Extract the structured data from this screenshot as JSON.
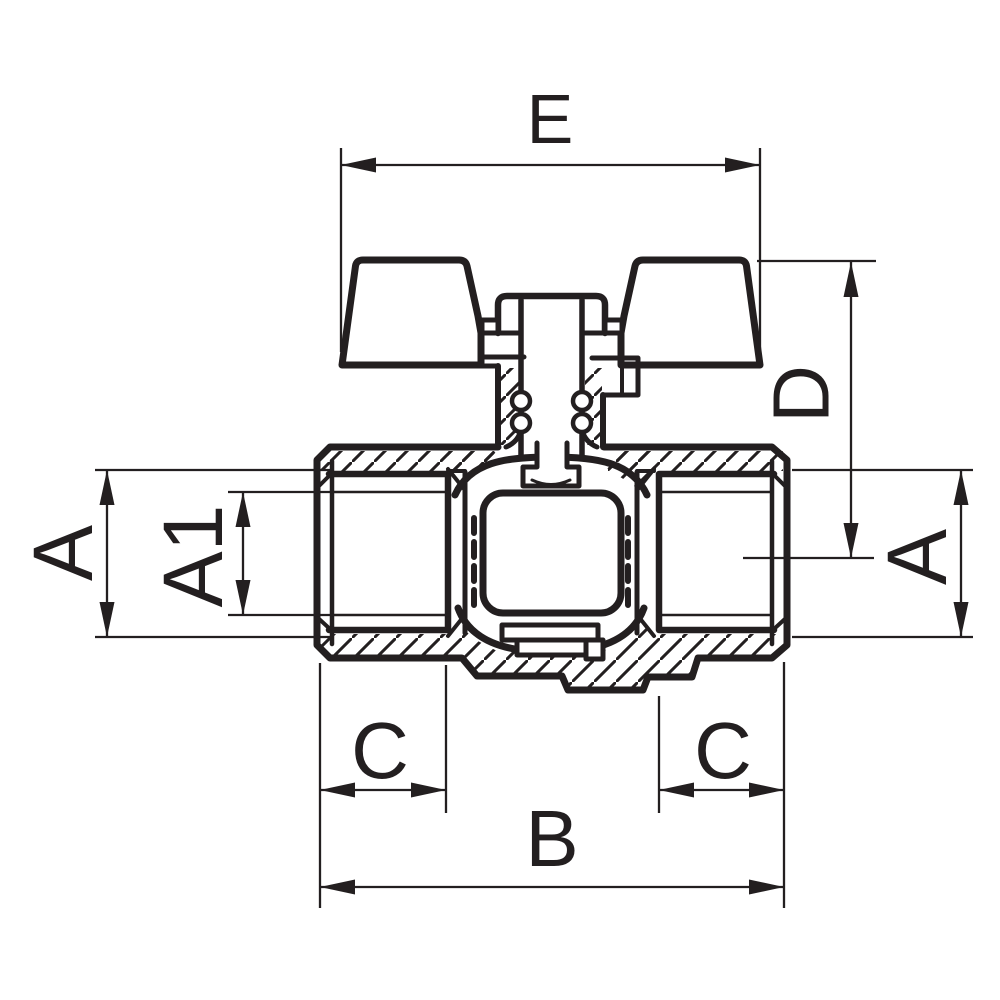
{
  "drawing": {
    "description": "ball-valve-cross-section-technical-drawing",
    "background": "#ffffff",
    "line_color": "#231f20",
    "dimensions": {
      "e": {
        "label": "E"
      },
      "d": {
        "label": "D"
      },
      "a_left": {
        "label": "A"
      },
      "a1_left": {
        "label": "A1"
      },
      "a_right": {
        "label": "A"
      },
      "c_left": {
        "label": "C"
      },
      "c_right": {
        "label": "C"
      },
      "b": {
        "label": "B"
      }
    }
  }
}
